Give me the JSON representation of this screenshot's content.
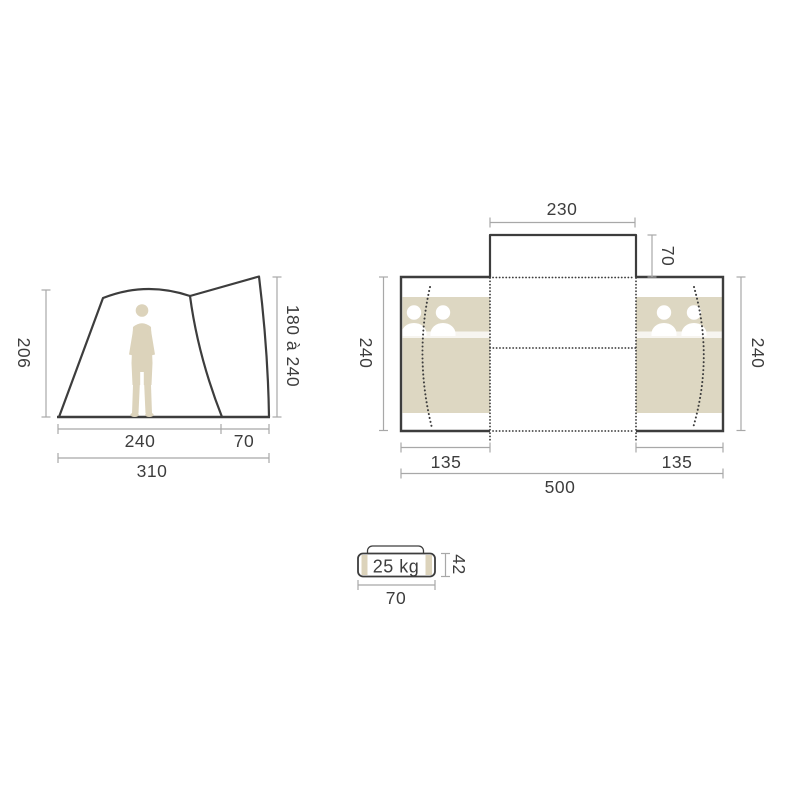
{
  "side_view": {
    "height_left": "206",
    "height_right": "180 à 240",
    "floor_main": "240",
    "floor_porch": "70",
    "floor_total": "310"
  },
  "top_view": {
    "porch_width": "230",
    "porch_depth": "70",
    "depth_left": "240",
    "depth_right": "240",
    "bedroom_left": "135",
    "bedroom_right": "135",
    "width_total": "500"
  },
  "pack_size": {
    "weight": "25 kg",
    "height": "42",
    "width": "70"
  },
  "colors": {
    "outline": "#3d3d3d",
    "dimension_line": "#a8a8a8",
    "fill_beige": "#ddd7c2",
    "text": "#3d3d3d",
    "background": "#ffffff"
  }
}
